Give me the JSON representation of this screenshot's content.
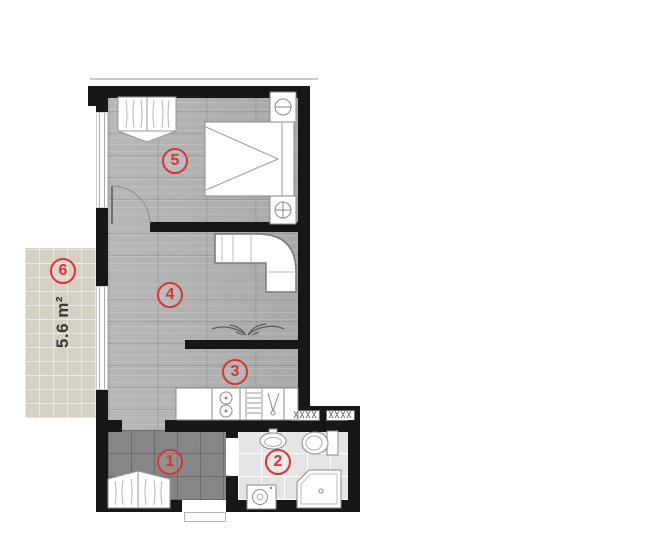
{
  "plan": {
    "labels": {
      "hall": "1",
      "bathroom": "2",
      "kitchen": "3",
      "living_room": "4",
      "bedroom": "5",
      "balcony": "6"
    },
    "balcony_area": "5.6 m²"
  },
  "colors": {
    "wall": "#171717",
    "label_red": "#d93434",
    "wood_floor": "#b2b2b2",
    "hall_tile": "#868686",
    "bath_tile": "#e4e4e4",
    "balcony_tile": "#d6cfc3"
  }
}
